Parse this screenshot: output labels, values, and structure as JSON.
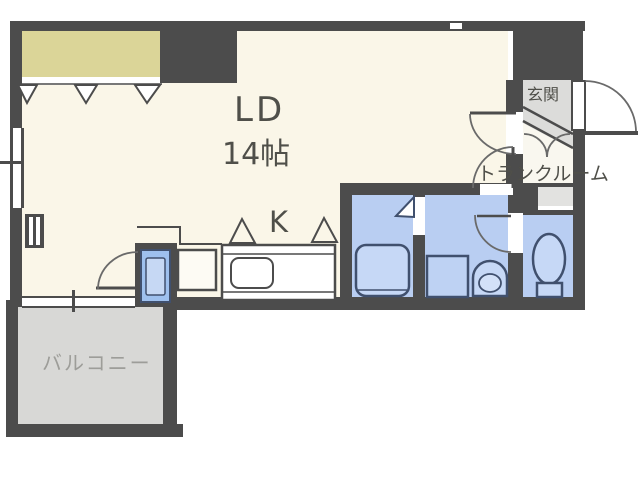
{
  "title": "apartment-floor-plan",
  "labels": {
    "living_dining": "LD",
    "living_dining_size": "14帖",
    "kitchen": "K",
    "entrance": "玄関",
    "trunk_room": "トランクルーム",
    "balcony": "バルコニー"
  },
  "rooms": [
    {
      "id": "living-dining",
      "label": "LD 14帖"
    },
    {
      "id": "kitchen",
      "label": "K"
    },
    {
      "id": "entrance",
      "label": "玄関"
    },
    {
      "id": "trunk-room",
      "label": "トランクルーム"
    },
    {
      "id": "balcony",
      "label": "バルコニー"
    },
    {
      "id": "bathroom",
      "label": ""
    },
    {
      "id": "washroom",
      "label": ""
    },
    {
      "id": "toilet",
      "label": ""
    }
  ],
  "colors": {
    "wall": "#4c4c4c",
    "floor_cream": "#faf6e8",
    "closet_yellow": "#dbd598",
    "water_room_blue": "#b9cef2",
    "fixture_fill": "#c6d8f6",
    "fixture_stroke": "#46587c",
    "concrete_gray": "#d8d8d6",
    "text": "#4f4f49",
    "balcony_text": "#9d9d99"
  }
}
